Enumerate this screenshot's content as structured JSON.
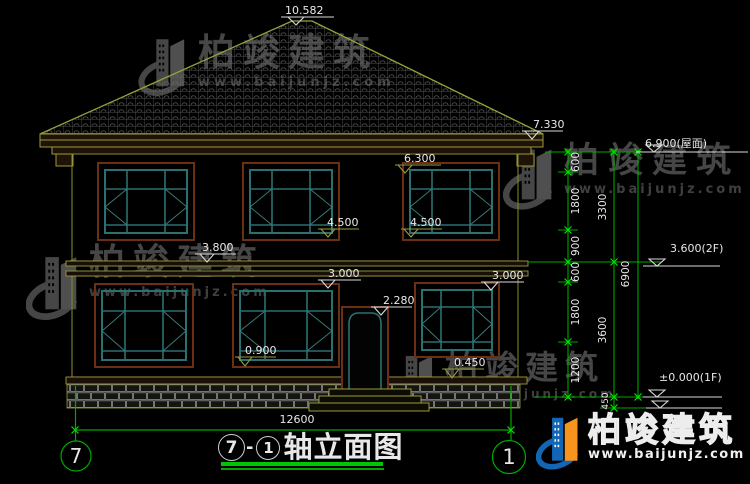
{
  "watermark": {
    "brand": "柏竣建筑",
    "url": "www.baijunjz.com"
  },
  "logo": {
    "brand": "柏竣建筑",
    "url": "www.baijunjz.com"
  },
  "title": {
    "axis_start": "7",
    "dash": "-",
    "axis_end": "1",
    "text": "轴立面图"
  },
  "axes": {
    "left": "7",
    "right": "1"
  },
  "marks": {
    "ridge": "10.582",
    "eave": "7.330",
    "roof_level": "6.900(屋面)",
    "floor2": "3.600(2F)",
    "floor1": "±0.000(1F)",
    "win2_top": "6.300",
    "win2_sill_l": "4.500",
    "win2_sill_r": "4.500",
    "band": "3.800",
    "win1_top_l": "3.000",
    "win1_top_r": "3.000",
    "door_top": "2.280",
    "win1_sill": "0.900",
    "plinth_top": "0.450"
  },
  "dims": {
    "right_inner": [
      "600",
      "1800",
      "900",
      "600",
      "1800",
      "1200"
    ],
    "right_mid": [
      "3300",
      "3600",
      "450"
    ],
    "right_outer": [
      "6900"
    ],
    "bottom_total": "12600"
  }
}
